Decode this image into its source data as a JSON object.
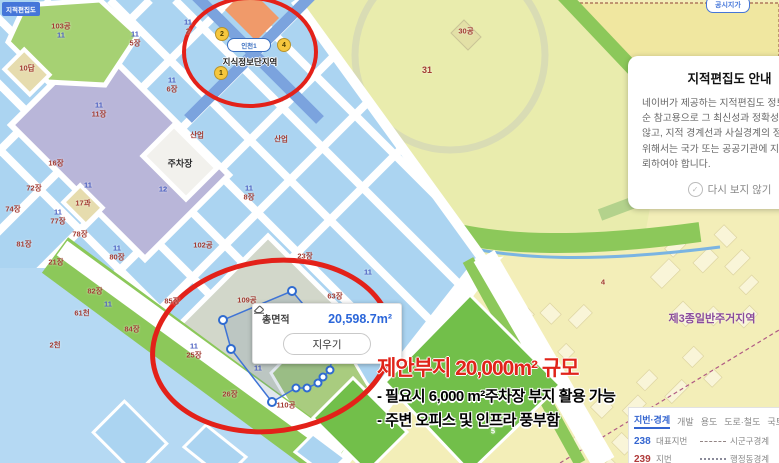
{
  "colors": {
    "red": "#a23b32",
    "blue": "#4a5fc0",
    "dark": "#2b2b2b",
    "white": "#ffffff",
    "purple": "#8a4b9c"
  },
  "chips": {
    "top_left": "지적편집도",
    "top_right": "공시지가"
  },
  "station": {
    "badge": "인천1",
    "name": "지식정보단지역",
    "exits": [
      {
        "n": "2",
        "x": 221,
        "y": 33
      },
      {
        "n": "4",
        "x": 283,
        "y": 44
      },
      {
        "n": "1",
        "x": 220,
        "y": 72
      }
    ]
  },
  "measure": {
    "total_label": "총면적",
    "value": "20,598.7m²",
    "clear": "지우기"
  },
  "annotation": {
    "title": "제안부지 20,000m² 규모",
    "lines": [
      "- 필요시 6,000 m²주차장 부지 활용 가능",
      "- 주변 오피스 및 인프라 풍부함"
    ]
  },
  "notice": {
    "title": "지적편집도 안내",
    "body_lines": [
      "네이버가 제공하는 지적편집도 정보는 단",
      "순 참고용으로 그 최신성과 정확성을 보장하지",
      "않고, 지적 경계선과 사실경계의 정확한 확인을",
      "위해서는 국가 또는 공공기관에 지적측량을 의",
      "뢰하여야 합니다."
    ],
    "dismiss": "다시 보지 않기",
    "check_icon": "✓"
  },
  "legend": {
    "tabs": [
      {
        "label": "지번·경계",
        "active": true
      },
      {
        "label": "개발"
      },
      {
        "label": "용도"
      },
      {
        "label": "도로·철도"
      },
      {
        "label": "국토계획"
      }
    ],
    "rows": [
      {
        "num": "238",
        "num_color": "#3465d0",
        "label": "대표지번",
        "line": "dashed",
        "line_label": "시군구경계"
      },
      {
        "num": "239",
        "num_color": "#b03a3a",
        "label": "지번",
        "line": "dotted",
        "line_label": "행정동경계"
      }
    ]
  },
  "map": {
    "labels": [
      {
        "t": "103공",
        "x": 61,
        "y": 26,
        "c": "red"
      },
      {
        "t": "11",
        "x": 61,
        "y": 35,
        "c": "blue"
      },
      {
        "t": "10답",
        "x": 27,
        "y": 68,
        "c": "red"
      },
      {
        "t": "11",
        "x": 135,
        "y": 34,
        "c": "blue"
      },
      {
        "t": "5장",
        "x": 135,
        "y": 43,
        "c": "red"
      },
      {
        "t": "11",
        "x": 188,
        "y": 22,
        "c": "blue"
      },
      {
        "t": "2",
        "x": 188,
        "y": 31,
        "c": "red"
      },
      {
        "t": "11",
        "x": 172,
        "y": 80,
        "c": "blue"
      },
      {
        "t": "6장",
        "x": 172,
        "y": 89,
        "c": "red"
      },
      {
        "t": "11",
        "x": 99,
        "y": 105,
        "c": "blue"
      },
      {
        "t": "11장",
        "x": 99,
        "y": 114,
        "c": "red"
      },
      {
        "t": "산업",
        "x": 197,
        "y": 135,
        "c": "red"
      },
      {
        "t": "산업",
        "x": 281,
        "y": 139,
        "c": "red"
      },
      {
        "t": "주차장",
        "x": 180,
        "y": 163,
        "c": "dark",
        "s": 9
      },
      {
        "t": "11",
        "x": 88,
        "y": 185,
        "c": "blue"
      },
      {
        "t": "12",
        "x": 163,
        "y": 189,
        "c": "blue"
      },
      {
        "t": "11",
        "x": 249,
        "y": 188,
        "c": "blue"
      },
      {
        "t": "8장",
        "x": 249,
        "y": 197,
        "c": "red"
      },
      {
        "t": "16장",
        "x": 56,
        "y": 163,
        "c": "red"
      },
      {
        "t": "72장",
        "x": 34,
        "y": 188,
        "c": "red"
      },
      {
        "t": "74장",
        "x": 13,
        "y": 209,
        "c": "red"
      },
      {
        "t": "17과",
        "x": 83,
        "y": 203,
        "c": "red"
      },
      {
        "t": "11",
        "x": 58,
        "y": 212,
        "c": "blue"
      },
      {
        "t": "77장",
        "x": 58,
        "y": 221,
        "c": "red"
      },
      {
        "t": "78장",
        "x": 80,
        "y": 234,
        "c": "red"
      },
      {
        "t": "81장",
        "x": 24,
        "y": 244,
        "c": "red"
      },
      {
        "t": "21장",
        "x": 56,
        "y": 262,
        "c": "red"
      },
      {
        "t": "11",
        "x": 117,
        "y": 248,
        "c": "blue"
      },
      {
        "t": "80장",
        "x": 117,
        "y": 257,
        "c": "red"
      },
      {
        "t": "82장",
        "x": 95,
        "y": 291,
        "c": "red"
      },
      {
        "t": "102공",
        "x": 203,
        "y": 245,
        "c": "red"
      },
      {
        "t": "23장",
        "x": 305,
        "y": 256,
        "c": "red"
      },
      {
        "t": "85장",
        "x": 172,
        "y": 301,
        "c": "red"
      },
      {
        "t": "84장",
        "x": 132,
        "y": 329,
        "c": "red"
      },
      {
        "t": "11",
        "x": 108,
        "y": 304,
        "c": "blue"
      },
      {
        "t": "61천",
        "x": 82,
        "y": 313,
        "c": "red"
      },
      {
        "t": "2천",
        "x": 55,
        "y": 345,
        "c": "red"
      },
      {
        "t": "109공",
        "x": 247,
        "y": 300,
        "c": "red"
      },
      {
        "t": "63장",
        "x": 335,
        "y": 296,
        "c": "red"
      },
      {
        "t": "11",
        "x": 368,
        "y": 272,
        "c": "blue"
      },
      {
        "t": "11",
        "x": 194,
        "y": 346,
        "c": "blue"
      },
      {
        "t": "25장",
        "x": 194,
        "y": 355,
        "c": "red"
      },
      {
        "t": "26장",
        "x": 230,
        "y": 394,
        "c": "red"
      },
      {
        "t": "110공",
        "x": 286,
        "y": 405,
        "c": "red"
      },
      {
        "t": "11",
        "x": 258,
        "y": 368,
        "c": "blue"
      },
      {
        "t": "31",
        "x": 427,
        "y": 70,
        "c": "red",
        "s": 9
      },
      {
        "t": "30공",
        "x": 466,
        "y": 31,
        "c": "red"
      },
      {
        "t": "190",
        "x": 715,
        "y": 170,
        "c": "red",
        "s": 9
      },
      {
        "t": "3공",
        "x": 681,
        "y": 199,
        "c": "red"
      },
      {
        "t": "4",
        "x": 603,
        "y": 282,
        "c": "red"
      },
      {
        "t": "6",
        "x": 387,
        "y": 418,
        "c": "white"
      },
      {
        "t": "5",
        "x": 493,
        "y": 431,
        "c": "white"
      },
      {
        "t": "제3종일반주거지역",
        "x": 712,
        "y": 318,
        "c": "purple",
        "s": 11,
        "b": true
      }
    ]
  }
}
